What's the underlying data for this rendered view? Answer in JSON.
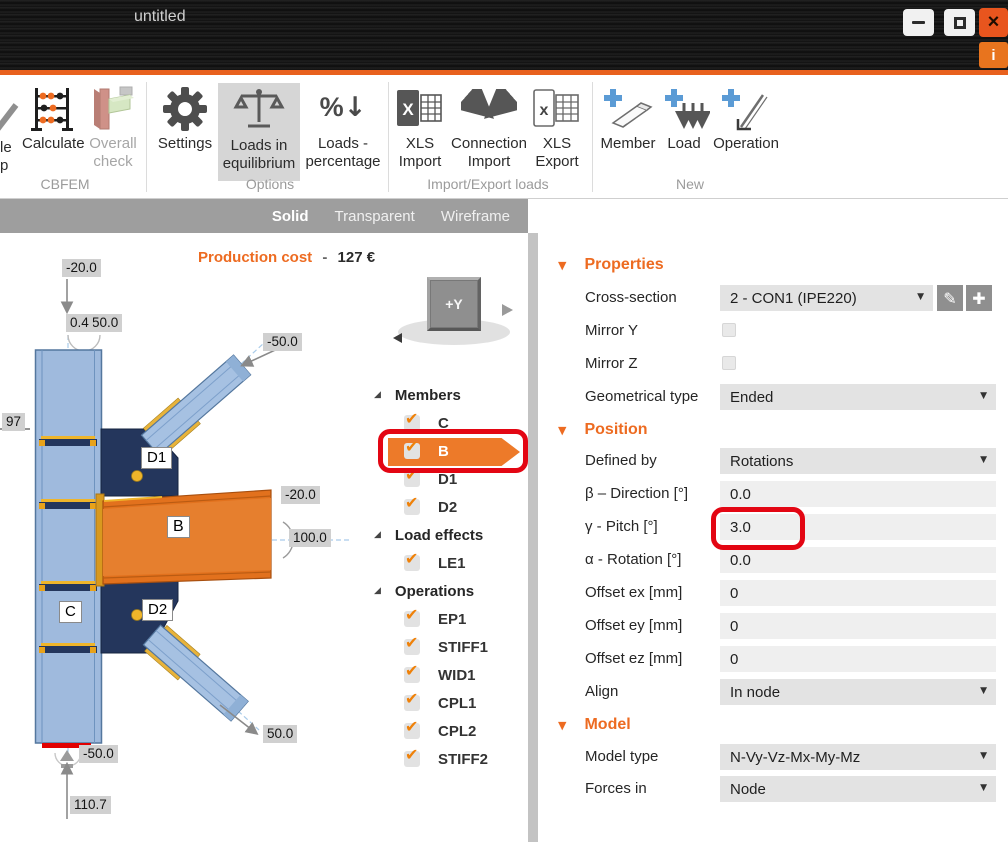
{
  "window": {
    "title": "untitled"
  },
  "icons": {
    "caret": "▼",
    "check": "✔",
    "pencil": "✎",
    "plus": "✚",
    "tree_expander": "◢",
    "section_marker": "▼",
    "close": "×",
    "info": "i",
    "percent": "%",
    "down_arrow": "↓",
    "load_arrows": "↓↓↓",
    "xls_x_import": "X",
    "xls_x_export": "x"
  },
  "ribbon": {
    "clipped": {
      "line1": "le",
      "line2": "p"
    },
    "groups": [
      {
        "name": "CBFEM",
        "items": [
          {
            "label1": "Calculate",
            "label2": ""
          },
          {
            "label1": "Overall",
            "label2": "check"
          }
        ]
      },
      {
        "name": "Options",
        "items": [
          {
            "label1": "Settings",
            "label2": ""
          },
          {
            "label1": "Loads in",
            "label2": "equilibrium"
          },
          {
            "label1": "Loads -",
            "label2": "percentage"
          }
        ]
      },
      {
        "name": "Import/Export loads",
        "items": [
          {
            "label1": "XLS",
            "label2": "Import"
          },
          {
            "label1": "Connection",
            "label2": "Import"
          },
          {
            "label1": "XLS",
            "label2": "Export"
          }
        ]
      },
      {
        "name": "New",
        "items": [
          {
            "label1": "Member",
            "label2": ""
          },
          {
            "label1": "Load",
            "label2": ""
          },
          {
            "label1": "Operation",
            "label2": ""
          }
        ]
      }
    ]
  },
  "viewport": {
    "tabs": [
      "Solid",
      "Transparent",
      "Wireframe"
    ],
    "production_cost_label": "Production cost",
    "production_cost_sep": "-",
    "production_cost_value": "127 €",
    "cube_label": "+Y",
    "member_tags": {
      "d1": "D1",
      "b": "B",
      "d2": "D2",
      "c": "C"
    },
    "dims": {
      "top": "-20.0",
      "mid1": "0.4",
      "mid2": "50.0",
      "upper_right": "-50.0",
      "left": "97",
      "beam_top": "-20.0",
      "beam_end": "100.0",
      "lower_right": "50.0",
      "bottom": "-50.0",
      "base": "110.7"
    }
  },
  "tree": {
    "sections": [
      {
        "label": "Members",
        "items": [
          {
            "label": "C"
          },
          {
            "label": "B",
            "selected": true
          },
          {
            "label": "D1"
          },
          {
            "label": "D2"
          }
        ]
      },
      {
        "label": "Load effects",
        "items": [
          {
            "label": "LE1"
          }
        ]
      },
      {
        "label": "Operations",
        "items": [
          {
            "label": "EP1"
          },
          {
            "label": "STIFF1"
          },
          {
            "label": "WID1"
          },
          {
            "label": "CPL1"
          },
          {
            "label": "CPL2"
          },
          {
            "label": "STIFF2"
          }
        ]
      }
    ]
  },
  "detail": {
    "header": {
      "name": "B",
      "type": "[Member]",
      "actions": [
        "Set bearing",
        "Copy",
        "Delete"
      ]
    },
    "sections": [
      {
        "title": "Properties"
      },
      {
        "title": "Position"
      },
      {
        "title": "Model"
      }
    ],
    "rows": {
      "cross_section": {
        "label": "Cross-section",
        "value": "2 - CON1 (IPE220)"
      },
      "mirror_y": {
        "label": "Mirror Y",
        "checked": false
      },
      "mirror_z": {
        "label": "Mirror Z",
        "checked": false
      },
      "geom_type": {
        "label": "Geometrical type",
        "value": "Ended"
      },
      "defined_by": {
        "label": "Defined by",
        "value": "Rotations"
      },
      "beta": {
        "label": "β – Direction [°]",
        "value": "0.0"
      },
      "gamma": {
        "label": "γ - Pitch [°]",
        "value": "3.0"
      },
      "alpha": {
        "label": "α - Rotation [°]",
        "value": "0.0"
      },
      "offset_ex": {
        "label": "Offset ex [mm]",
        "value": "0"
      },
      "offset_ey": {
        "label": "Offset ey [mm]",
        "value": "0"
      },
      "offset_ez": {
        "label": "Offset ez [mm]",
        "value": "0"
      },
      "align": {
        "label": "Align",
        "value": "In node"
      },
      "model_type": {
        "label": "Model type",
        "value": "N-Vy-Vz-Mx-My-Mz"
      },
      "forces_in": {
        "label": "Forces in",
        "value": "Node"
      }
    }
  },
  "colors": {
    "accent": "#ED6B21",
    "annotation_red": "#E30613",
    "beam_selected_orange": "#E2711D",
    "member_blue": "#9FBADD",
    "plate_navy": "#24365C",
    "bolt_yellow": "#EFB52A",
    "support_red": "#E10000"
  }
}
